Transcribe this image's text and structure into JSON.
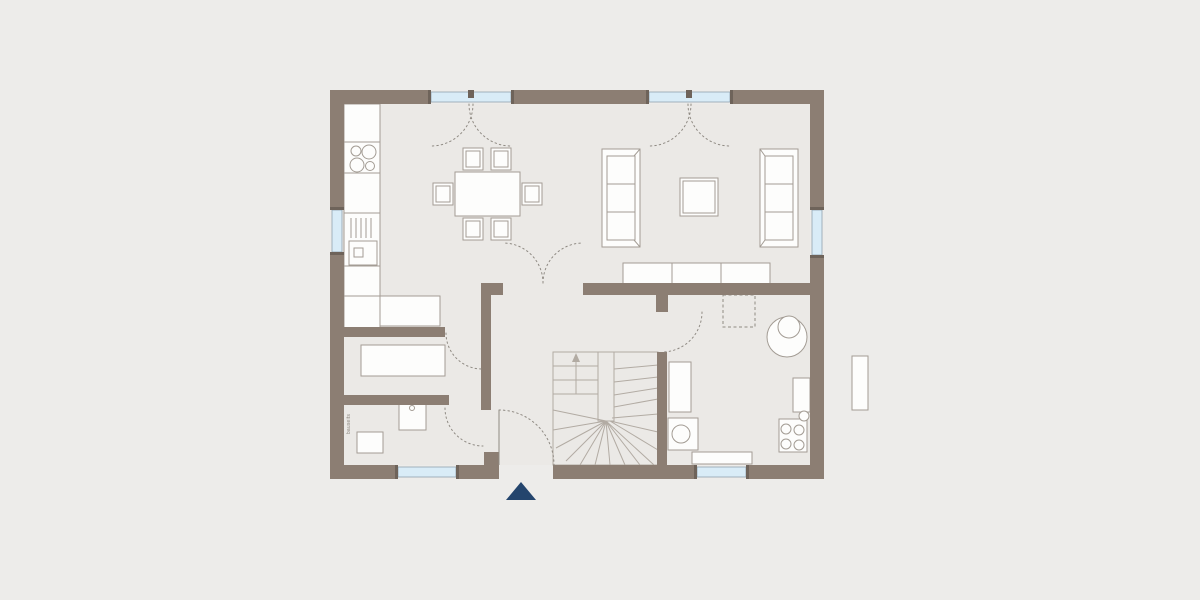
{
  "plan": {
    "type": "floor-plan",
    "labels": {
      "utility_washer": "bauseits",
      "utility_left_vertical": "bauseits"
    },
    "fixtures": [
      "cooktop",
      "kitchen-counter",
      "kitchen-sink",
      "drainer",
      "dining-table",
      "chair",
      "terrace-door",
      "window",
      "sofa",
      "coffee-table",
      "sideboard",
      "wardrobe",
      "staircase-winder",
      "up-arrow",
      "washing-machine",
      "freezer",
      "water-tank",
      "heating-unit",
      "service-shaft",
      "cabinet",
      "window-sill",
      "front-door",
      "entrance-triangle"
    ],
    "colors": {
      "background": "#edecea",
      "floor": "#ebe9e6",
      "wall": "#8c7e73",
      "window_cap": "#6e635a",
      "window_glass": "#d9ecf7",
      "window_frame": "#8fa3b0",
      "furniture_fill": "#fdfdfc",
      "furniture_stroke": "#a39c94",
      "stair_stroke": "#b2aba3",
      "dashed_line": "#8f8a83",
      "label_text": "#8b857d",
      "entrance_marker": "#24456d"
    }
  }
}
